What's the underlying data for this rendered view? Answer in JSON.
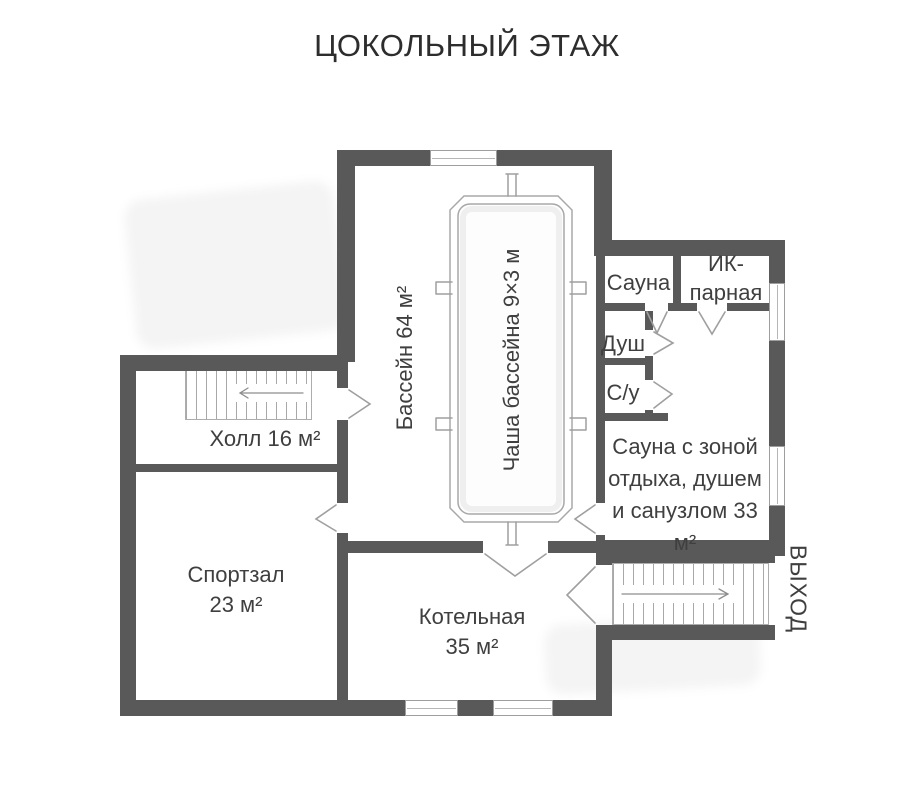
{
  "title": "ЦОКОЛЬНЫЙ ЭТАЖ",
  "colors": {
    "wall": "#595959",
    "line": "#9e9e9e",
    "text": "#3f3f3f",
    "background": "#ffffff"
  },
  "rooms": {
    "pool_hall": {
      "label": "Бассейн 64 м²"
    },
    "pool_bowl": {
      "label": "Чаша бассейна 9×3 м"
    },
    "sauna": {
      "label": "Сауна"
    },
    "ir_steam_room": {
      "label": "ИК-парная"
    },
    "shower": {
      "label": "Душ"
    },
    "wc": {
      "label": "С/у"
    },
    "sauna_lounge": {
      "label": "Сауна с зоной отдыха, душем и санузлом 33 м²"
    },
    "hall": {
      "label": "Холл 16 м²"
    },
    "gym": {
      "label": "Спортзал 23 м²"
    },
    "boiler_room": {
      "label": "Котельная 35 м²"
    },
    "exit": {
      "label": "ВЫХОД"
    }
  }
}
